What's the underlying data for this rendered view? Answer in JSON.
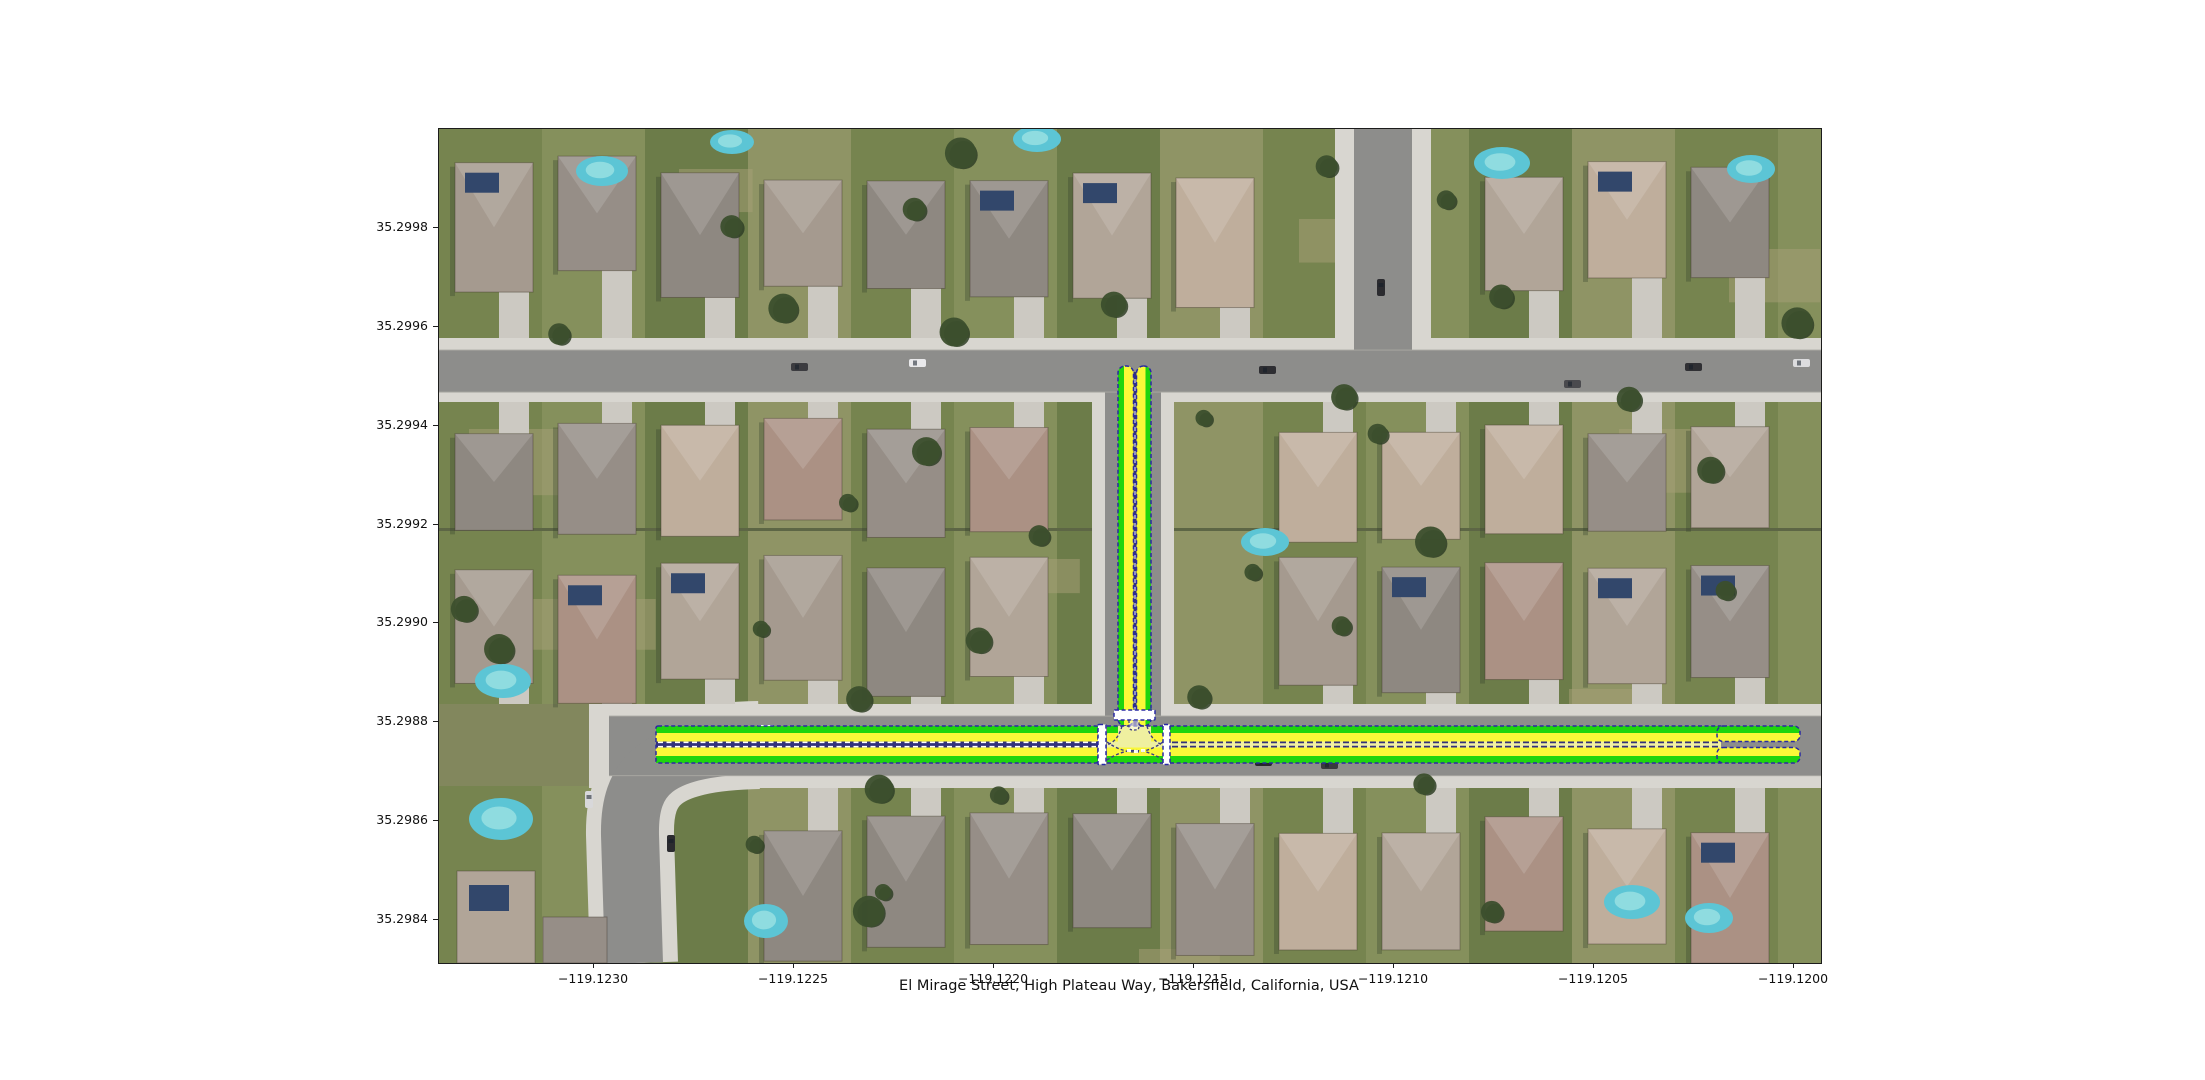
{
  "title": "El Mirage Street, High Plateau Way, Bakersfield, California, USA",
  "axes": {
    "x_ticks": [
      "−119.1230",
      "−119.1225",
      "−119.1220",
      "−119.1215",
      "−119.1210",
      "−119.1205",
      "−119.1200"
    ],
    "y_ticks": [
      "35.2998",
      "35.2996",
      "35.2994",
      "35.2992",
      "35.2990",
      "35.2988",
      "35.2986",
      "35.2984"
    ]
  },
  "overlay": {
    "colors": {
      "lane_green": "#1fd40e",
      "lane_yellow": "#faf838",
      "center_pale": "#f1f1a2",
      "center_navy": "#32327d",
      "border_blue": "#2929a3",
      "crosswalk_white": "#ffffff",
      "intersection_pale": "#eff0a0"
    }
  }
}
